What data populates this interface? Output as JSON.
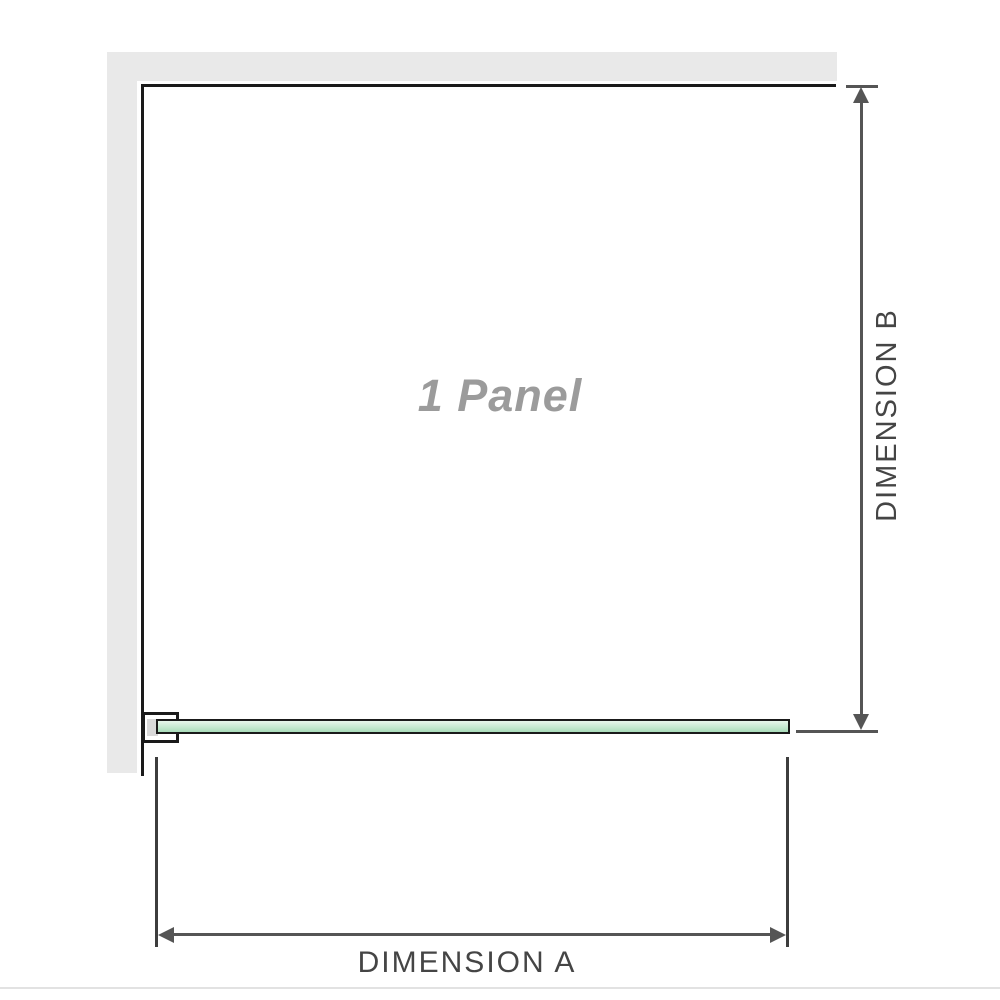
{
  "labels": {
    "panel": "1 Panel",
    "dimension_a": "DIMENSION A",
    "dimension_b": "DIMENSION B"
  },
  "colors": {
    "wall": "#e9e9e9",
    "frame": "#1a1a1a",
    "glass_light": "#e8f6ec",
    "glass_dark": "#a9dcba",
    "dim_line": "#555555",
    "tick": "#3d3d3d",
    "label_text": "#454545",
    "panel_text": "#9b9b9b",
    "rule": "#e2e2e2"
  }
}
